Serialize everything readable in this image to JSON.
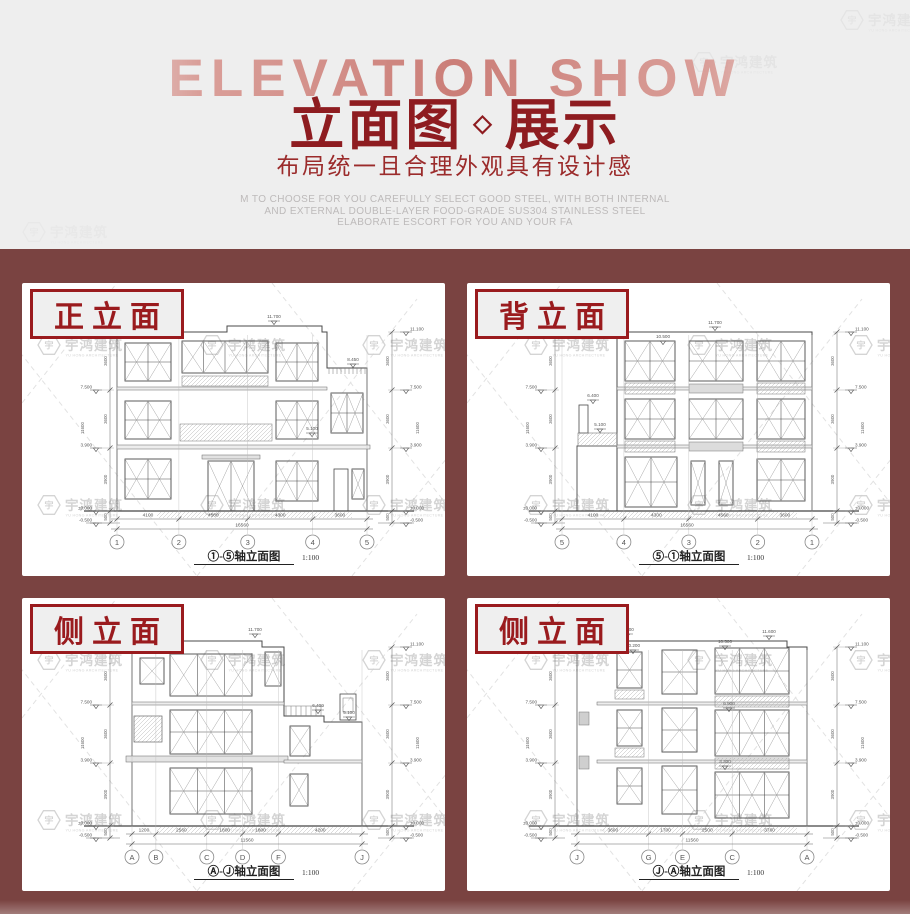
{
  "colors": {
    "page_bg": "#eeeeee",
    "section_bg": "#7a4341",
    "accent_red": "#8e1c20",
    "label_red": "#9a1b1e",
    "faded_word": "#d89a94",
    "desc_gray": "#bdbaba",
    "watermark_gray": "#d0d0d0"
  },
  "header": {
    "bg_text": "ELEVATION SHOW",
    "title_a": "立面图",
    "diamond": "◇",
    "title_b": "展示",
    "subtitle": "布局统一且合理外观具有设计感",
    "desc_lines": [
      "M TO CHOOSE FOR YOU CAREFULLY SELECT GOOD STEEL, WITH BOTH INTERNAL",
      "AND EXTERNAL DOUBLE-LAYER FOOD-GRADE SUS304 STAINLESS STEEL",
      "ELABORATE ESCORT FOR YOU AND YOUR FA"
    ]
  },
  "watermark": {
    "cn": "宇鸿建筑",
    "en": "YU HONG ARCHITECTURE",
    "mark": "宇"
  },
  "caption_word": "轴立面图",
  "scale": "1:100",
  "levels": [
    "11.100",
    "7.500",
    "3.900",
    "±0.000",
    "-0.500"
  ],
  "seg_dims": [
    "3600",
    "3600",
    "3900",
    "500"
  ],
  "overall_dim": "11600",
  "panels": [
    {
      "variant": "front",
      "label": "正立面",
      "caption_prefix": "①-⑤",
      "axes": [
        "1",
        "2",
        "3",
        "4",
        "5"
      ],
      "axis_dims": [
        "4100",
        "4560",
        "4300",
        "3600"
      ],
      "total_dim": "16560",
      "roof_marks": [
        [
          "11.600",
          145,
          44
        ],
        [
          "11.700",
          252,
          38
        ],
        [
          "8.450",
          331,
          81
        ],
        [
          "5.100",
          290,
          150
        ]
      ]
    },
    {
      "variant": "back",
      "label": "背立面",
      "caption_prefix": "⑤-①",
      "axes": [
        "5",
        "4",
        "3",
        "2",
        "1"
      ],
      "axis_dims": [
        "4100",
        "4300",
        "4560",
        "3600"
      ],
      "total_dim": "16560",
      "roof_marks": [
        [
          "11.700",
          248,
          44
        ],
        [
          "10.500",
          196,
          58
        ],
        [
          "6.400",
          126,
          117
        ],
        [
          "5.100",
          133,
          146
        ]
      ]
    },
    {
      "variant": "sideL",
      "label": "侧立面",
      "caption_prefix": "Ⓐ-Ⓙ",
      "axes": [
        "A",
        "B",
        "C",
        "D",
        "F",
        "J"
      ],
      "axis_dims": [
        "1200",
        "2560",
        "1800",
        "1800",
        "4200"
      ],
      "total_dim": "11560",
      "roof_marks": [
        [
          "11.600",
          130,
          38
        ],
        [
          "11.700",
          233,
          36
        ],
        [
          "6.400",
          296,
          112
        ],
        [
          "5.100",
          327,
          119
        ]
      ]
    },
    {
      "variant": "sideR",
      "label": "侧立面",
      "caption_prefix": "Ⓙ-Ⓐ",
      "axes": [
        "J",
        "G",
        "E",
        "C",
        "A"
      ],
      "axis_dims": [
        "3600",
        "1700",
        "2500",
        "3760"
      ],
      "total_dim": "11560",
      "roof_marks": [
        [
          "11.700",
          160,
          36
        ],
        [
          "10.200",
          166,
          52
        ],
        [
          "10.500",
          258,
          48
        ],
        [
          "11.600",
          302,
          38
        ],
        [
          "6.900",
          262,
          110
        ],
        [
          "3.300",
          258,
          168
        ]
      ]
    }
  ]
}
